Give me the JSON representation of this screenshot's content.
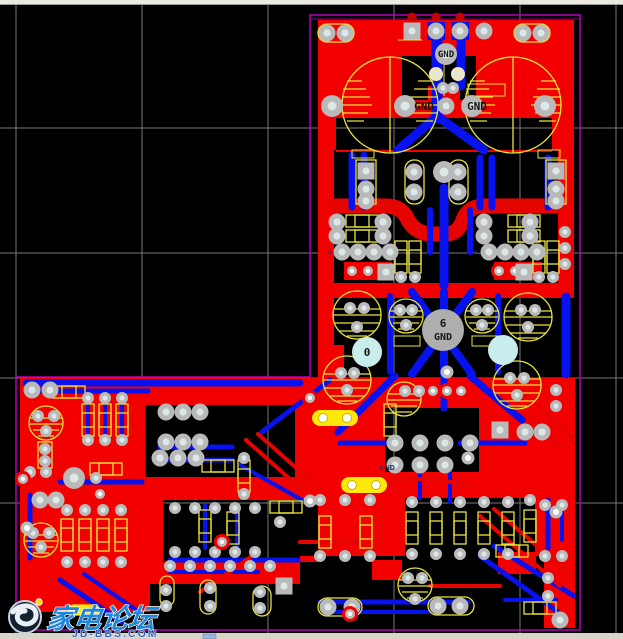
{
  "colors": {
    "bg": "#000000",
    "grid": "#787878",
    "outline": "#b400b4",
    "copper": "#f20000",
    "copper2": "#e60400",
    "trace": "#0712ee",
    "silk": "#e9e43a",
    "pad": "#b9b9b9",
    "hole": "#dcE8e8",
    "pad-cream": "#efe6c2",
    "pad-aqua": "#c9ecec",
    "pad-big": "#aeaeae",
    "jumper": "#ffe80a",
    "text-dark": "#141414",
    "chrome-top": "#ece9e0",
    "chrome-bottom": "#d8d4ca",
    "wm-blue": "#1e86dc",
    "wm-url": "#3063c0"
  },
  "labels": {
    "gnd_top": "GND",
    "gnd_cap_left": "GND",
    "gnd_cap_right": "GND",
    "big_pad_number": "6",
    "big_pad_net": "GND",
    "via_number": "0",
    "small_gnd": "GND",
    "net_mark": "M="
  },
  "watermark": {
    "site_name": "家电论坛",
    "site_url": "JD-BBS.COM"
  }
}
